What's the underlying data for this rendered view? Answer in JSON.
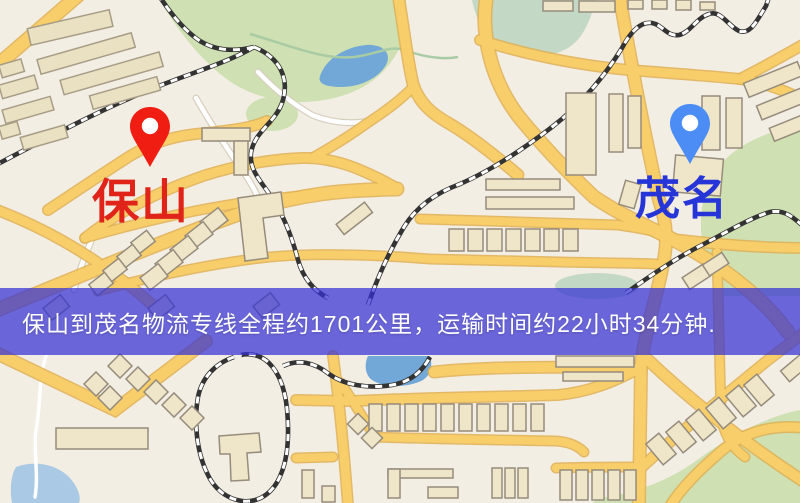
{
  "map": {
    "background_color": "#F3EEE4",
    "road_color": "#F7CE69",
    "origin_marker": {
      "label": "保山",
      "pin_color": "#EF1D12",
      "label_color": "#E0241A"
    },
    "destination_marker": {
      "label": "茂名",
      "pin_color": "#4C8DF5",
      "label_color": "#2535D8"
    },
    "banner": {
      "text": "保山到茂名物流专线全程约1701公里，运输时间约22小时34分钟.",
      "text_color": "#FFFFFF",
      "background_rgba": "rgba(53,49,212,0.72)",
      "base_color": "#3531D4"
    }
  }
}
